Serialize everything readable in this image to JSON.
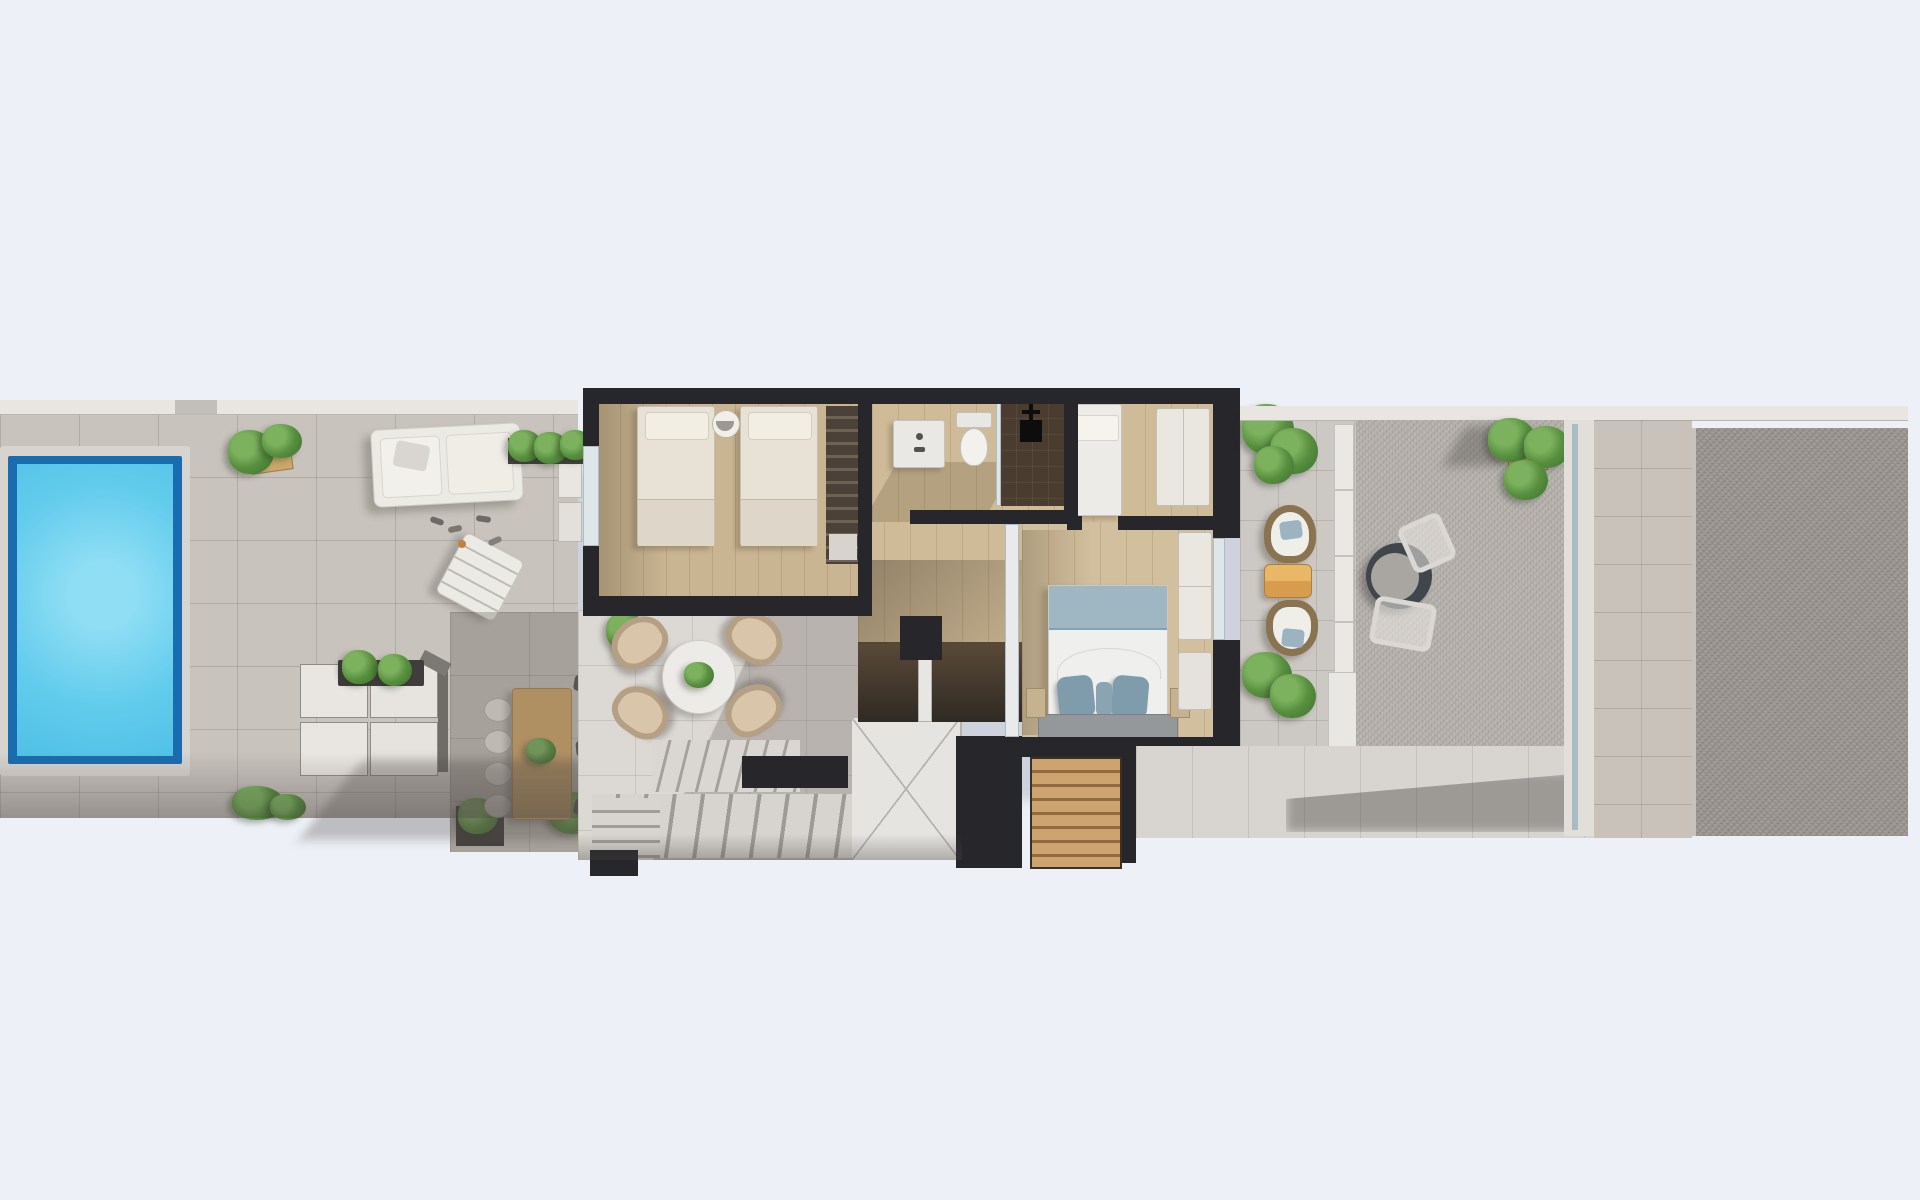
{
  "meta": {
    "title": "3D rendered floor plan - top view",
    "type": "architectural-floor-plan-render",
    "aria_label": "Top-down 3D render of an elongated villa plot: pool terrace with loungers and sofa on the left, upper-floor interior with two bedrooms, bathroom and master bedroom in the middle, lounge terrace with staircase below, balcony with cocoon chairs and an east gravel terrace with bistro table on the right"
  },
  "palette": {
    "background": "#edf0f7",
    "terrace_tile": "#c8c3bd",
    "white_tile": "#dcd9d5",
    "wall_dark": "#27272b",
    "wall_white": "#e9e6e2",
    "pool_rim": "#1a6cb0",
    "pool_water": "#5fc9ea",
    "wood_floor": "#c9b591",
    "wood_furniture": "#d4ab6c",
    "plant_green": "#578f3e",
    "bed_linen": "#e8e2d6",
    "master_bed_blue": "#9fb6c3",
    "accent_table_orange": "#d89c4e",
    "gravel_light": "#b7b2ad",
    "gravel_dark": "#9b9691"
  },
  "plan": {
    "zones": [
      {
        "name": "pool-terrace",
        "side": "west",
        "features": [
          "swimming-pool",
          "planter-box",
          "sun-daybed",
          "sun-lounger",
          "flip-flops",
          "modular-sofa-set",
          "planter-bar",
          "outdoor-dining-table",
          "dining-chairs",
          "bottom-planters"
        ]
      },
      {
        "name": "upper-floor-interior",
        "side": "center",
        "rooms": [
          {
            "name": "twin-bedroom",
            "furniture": [
              "single-bed",
              "single-bed",
              "round-side-table",
              "wardrobe-with-clothes",
              "glass-door"
            ]
          },
          {
            "name": "bathroom",
            "furniture": [
              "vanity-sink",
              "toilet",
              "walk-in-shower",
              "shower-head"
            ]
          },
          {
            "name": "small-bedroom",
            "furniture": [
              "single-bed",
              "wardrobe"
            ]
          },
          {
            "name": "master-bedroom",
            "furniture": [
              "double-bed",
              "pillows",
              "headboard-bench",
              "nightstand",
              "nightstand",
              "wardrobe",
              "desk",
              "sliding-glass-door"
            ]
          },
          {
            "name": "hallway",
            "furniture": []
          },
          {
            "name": "stairwell",
            "furniture": [
              "stair-flight-upper",
              "stair-flight-lower",
              "corner-steps",
              "landing",
              "wooden-steps"
            ]
          }
        ]
      },
      {
        "name": "lounge-terrace",
        "side": "center-south",
        "features": [
          "potted-plant",
          "round-coffee-table",
          "lounge-armchair-x4",
          "building-shadow"
        ]
      },
      {
        "name": "balcony",
        "side": "center-east",
        "features": [
          "potted-plant-top",
          "cocoon-chair",
          "orange-side-table",
          "cocoon-chair",
          "potted-plant-bottom",
          "white-parapet"
        ]
      },
      {
        "name": "east-terrace",
        "side": "east",
        "features": [
          "bistro-table",
          "bistro-chair",
          "bistro-chair",
          "potted-plant",
          "glass-walkway",
          "stone-path",
          "gravel-bed"
        ]
      }
    ]
  }
}
